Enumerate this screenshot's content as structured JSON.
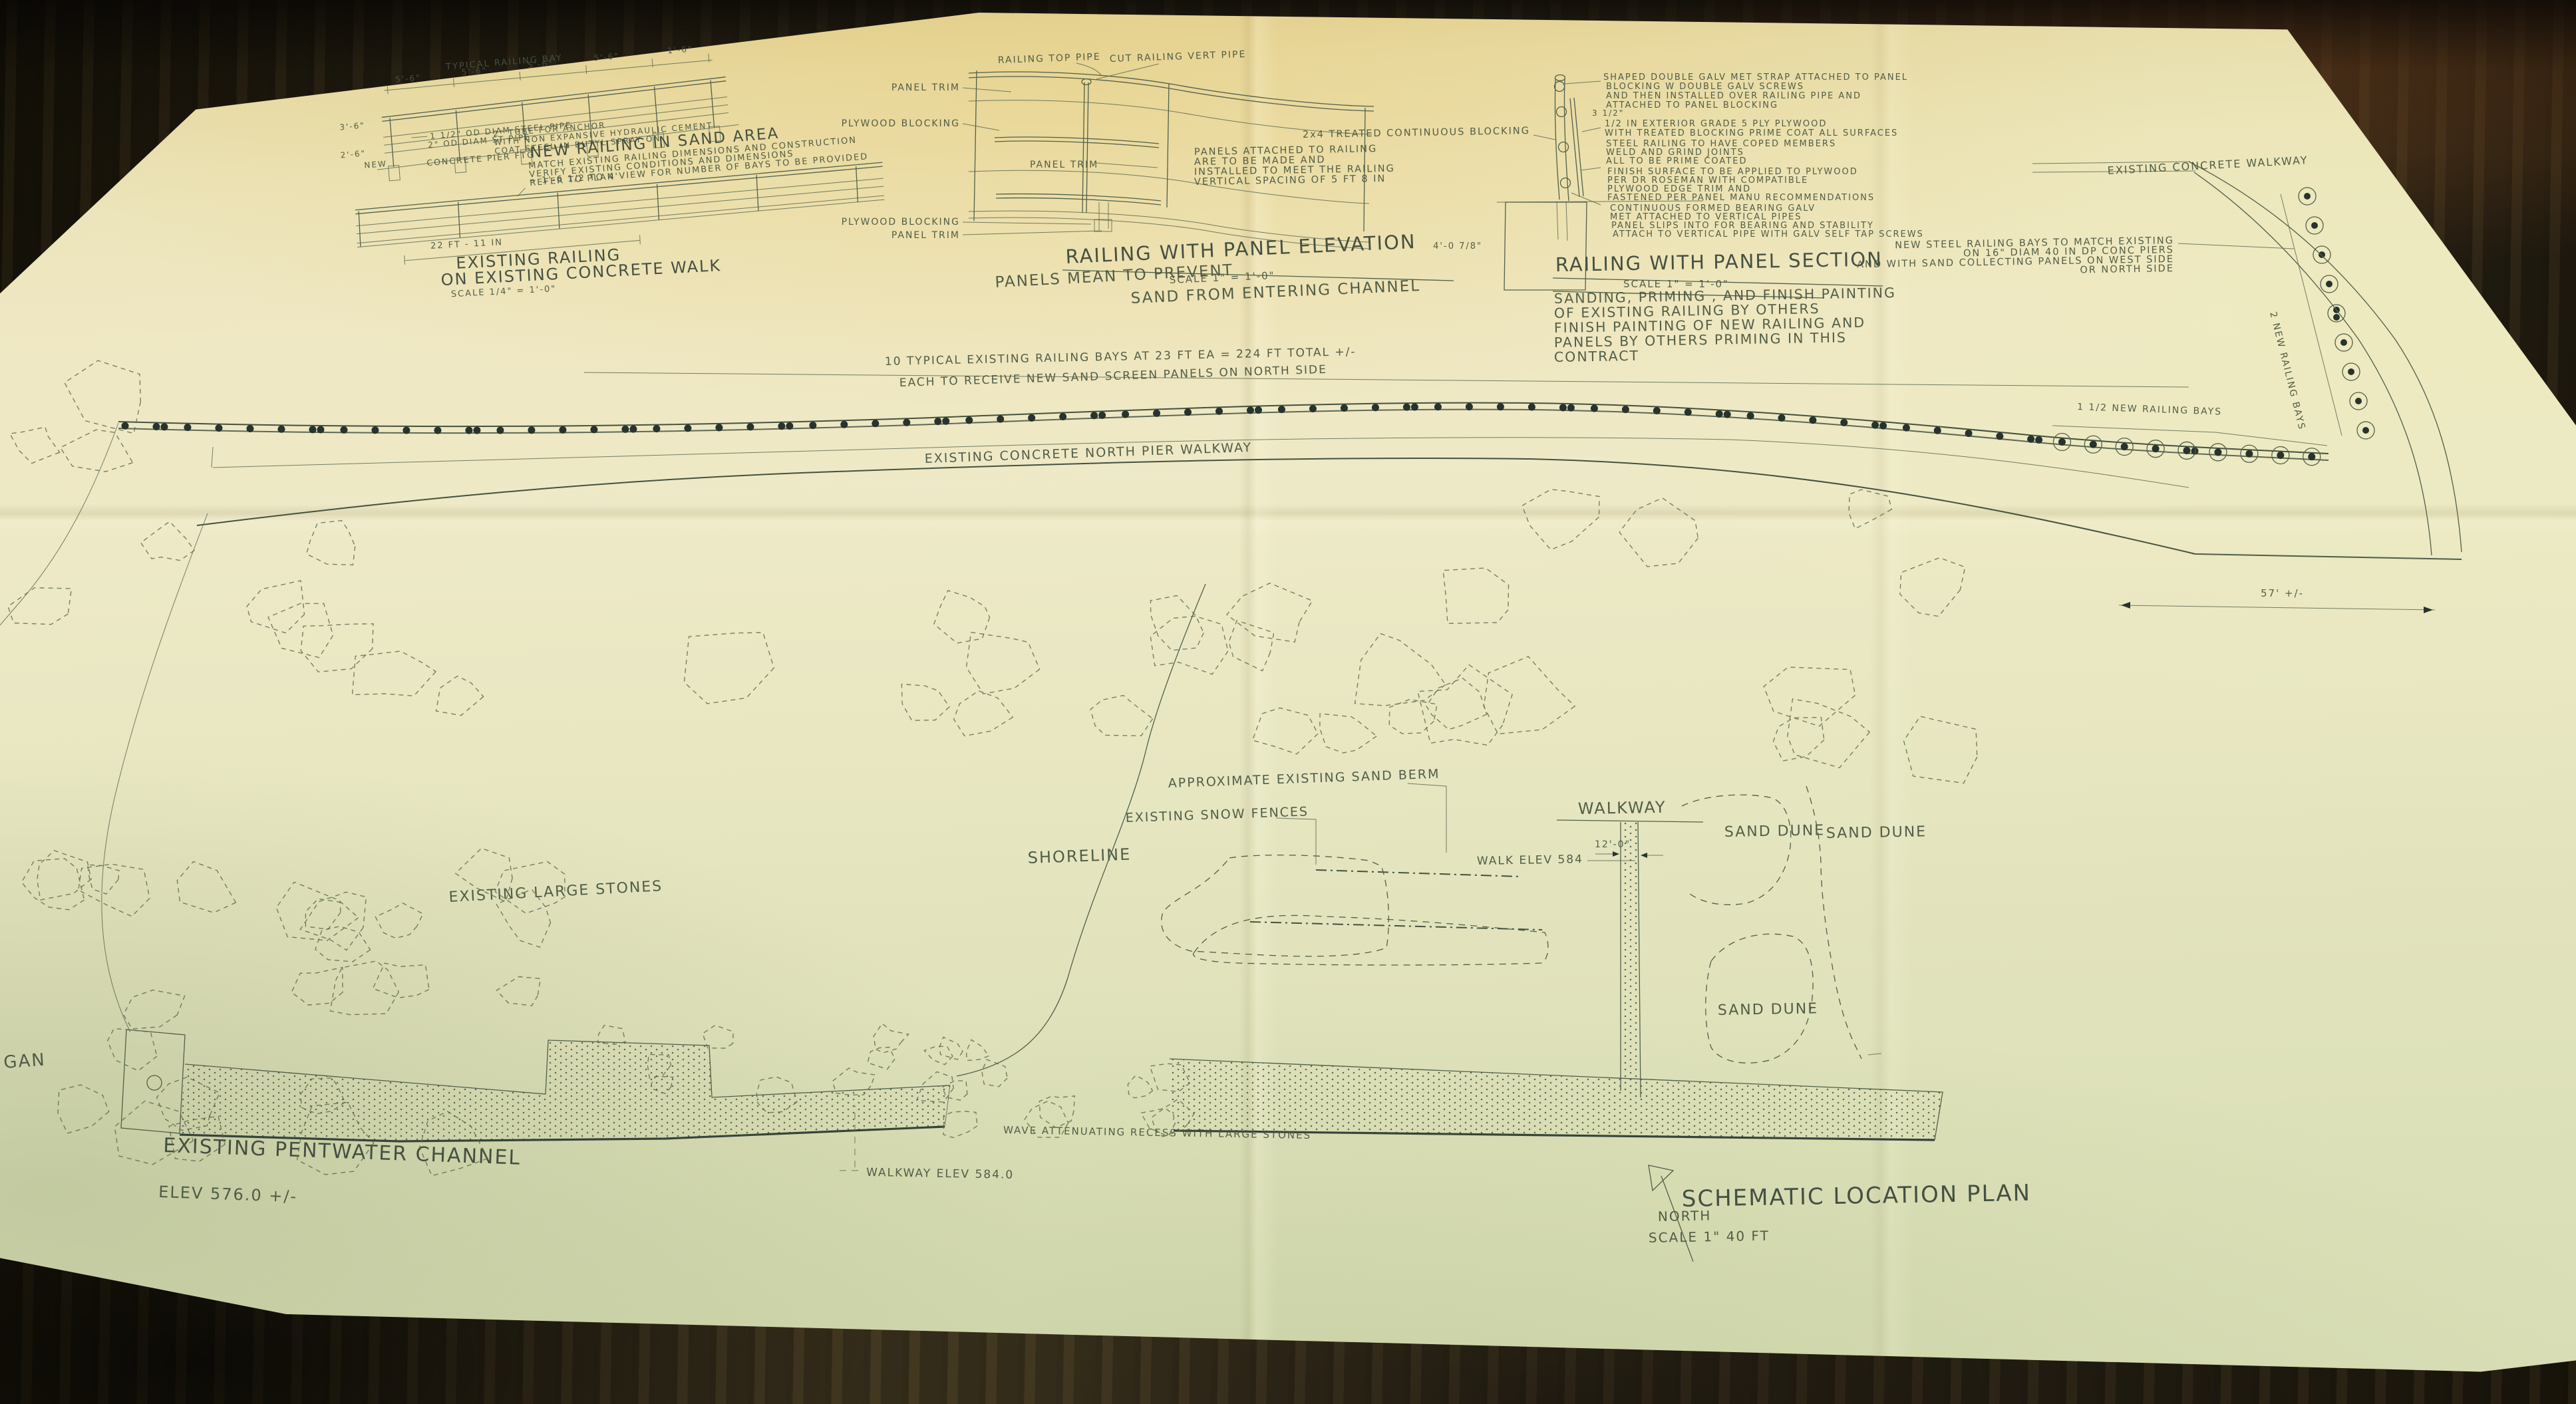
{
  "colors": {
    "paper": "#ece6c0",
    "paper_green": "#dde1b9",
    "ink": "#47543f",
    "table_wood": "#4c4026"
  },
  "a": {
    "caption": "TYPICAL RAILING BAY",
    "dims": [
      "5'-6\"",
      "5'-6\"",
      "5'-6\"",
      "5'-6\"",
      "1'-6\""
    ],
    "dim_left_top": "3'-6\"",
    "dim_left_bot": "2'-6\"",
    "pipe1": "1 1/2\" OD DIAM STEEL PIPE",
    "pipe2": "2\" OD DIAM ST PIPE",
    "anchor1": "2\" TUBE FOR ANCHOR",
    "anchor2": "WITH NON EXPANSIVE HYDRAULIC CEMENT",
    "anchor3": "COAT STEEL IN BUTYL SPRAY ON",
    "footing": "CONCRETE PIER FTG",
    "new_label": "NEW",
    "title": "NEW RAILING IN SAND AREA",
    "note1": "MATCH EXISTING RAILING DIMENSIONS AND CONSTRUCTION",
    "note2": "VERIFY EXISTING CONDITIONS AND DIMENSIONS",
    "note3": "REFER TO PLAN VIEW FOR NUMBER OF BAYS TO BE PROVIDED"
  },
  "b": {
    "range_note": "~ 1'-6 1/2 TO 4'",
    "dim": "22 FT - 11 IN",
    "title1": "EXISTING RAILING",
    "title2": "ON EXISTING CONCRETE WALK",
    "scale": "SCALE 1/4\" = 1'-0\""
  },
  "c": {
    "lbl_top_pipe": "RAILING TOP PIPE",
    "lbl_cut": "CUT RAILING VERT PIPE",
    "lbl_trim1": "PANEL TRIM",
    "lbl_ply1": "PLYWOOD BLOCKING",
    "lbl_trim2": "PANEL TRIM",
    "lbl_ply2": "PLYWOOD BLOCKING",
    "lbl_trim3": "PANEL TRIM",
    "note": [
      "PANELS ATTACHED TO RAILING",
      "ARE TO BE MADE AND",
      "INSTALLED TO MEET THE RAILING",
      "VERTICAL SPACING OF 5 FT 8 IN"
    ],
    "blocking_note": "2x4 TREATED CONTINUOUS BLOCKING",
    "title": "RAILING WITH PANEL ELEVATION",
    "scale": "SCALE 1\" = 1'-0\"",
    "subnote1": "PANELS MEAN TO PREVENT",
    "subnote2": "SAND FROM ENTERING CHANNEL"
  },
  "d": {
    "note_strap": [
      "SHAPED DOUBLE GALV MET STRAP ATTACHED TO PANEL",
      "BLOCKING W DOUBLE GALV SCREWS",
      "AND THEN INSTALLED OVER RAILING PIPE AND",
      "ATTACHED TO PANEL BLOCKING"
    ],
    "dim_width": "3 1/2\"",
    "note_ply": [
      "1/2 IN EXTERIOR GRADE 5 PLY PLYWOOD",
      "WITH TREATED BLOCKING PRIME COAT ALL SURFACES"
    ],
    "note_steel": [
      "STEEL RAILING TO HAVE COPED MEMBERS",
      "WELD AND GRIND JOINTS",
      "ALL TO BE PRIME COATED"
    ],
    "note_finish": [
      "FINISH SURFACE TO BE APPLIED TO PLYWOOD",
      "PER DR ROSEMAN WITH COMPATIBLE",
      "PLYWOOD EDGE TRIM AND",
      "FASTENED PER PANEL MANU RECOMMENDATIONS"
    ],
    "note_bearing": [
      "CONTINUOUS FORMED BEARING GALV",
      "MET ATTACHED TO VERTICAL PIPES",
      "PANEL SLIPS INTO FOR BEARING AND STABILITY",
      "ATTACH TO VERTICAL PIPE WITH GALV SELF TAP SCREWS"
    ],
    "dim_depth": "4'-0 7/8\"",
    "title": "RAILING WITH PANEL SECTION",
    "scale": "SCALE 1\" = 1'-0\"",
    "paint": [
      "SANDING, PRIMING , AND FINISH PAINTING",
      "OF EXISTING RAILING BY OTHERS",
      "FINISH PAINTING OF NEW RAILING AND",
      "PANELS BY OTHERS  PRIMING IN THIS",
      "CONTRACT"
    ]
  },
  "plan": {
    "note_bays": "10 TYPICAL EXISTING RAILING BAYS AT 23 FT EA = 224 FT TOTAL +/-",
    "note_panels": "EACH TO RECEIVE NEW SAND SCREEN PANELS ON NORTH SIDE",
    "walkway_label": "EXISTING CONCRETE NORTH PIER WALKWAY",
    "new_bays_note": [
      "NEW STEEL RAILING BAYS TO MATCH EXISTING",
      "ON 16\" DIAM 40 IN DP CONC PIERS",
      "AND WITH SAND COLLECTING PANELS ON WEST SIDE",
      "OR NORTH SIDE"
    ],
    "two_bays": "2 NEW RAILING BAYS",
    "bays15": "1 1/2 NEW RAILING BAYS",
    "conc_walkway": "EXISTING CONCRETE WALKWAY",
    "dim57": "57' +/-"
  },
  "loc": {
    "berm": "APPROXIMATE EXISTING SAND BERM",
    "fences": "EXISTING SNOW FENCES",
    "shoreline": "SHORELINE",
    "walkway": "WALKWAY",
    "walk_elev": "WALK ELEV 584",
    "dim12": "12'-0\"",
    "dune1": "SAND DUNE",
    "dune2": "SAND DUNE",
    "dune3": "SAND DUNE",
    "stones": "EXISTING LARGE STONES",
    "channel": "EXISTING PENTWATER CHANNEL",
    "channel_elev": "ELEV 576.0 +/-",
    "lake_fragment": "GAN",
    "walk_elev2": "WALKWAY ELEV 584.0",
    "wave": "WAVE ATTENUATING RECESS WITH LARGE STONES",
    "title": "SCHEMATIC LOCATION PLAN",
    "north": "NORTH",
    "scale": "SCALE 1\" 40 FT"
  }
}
